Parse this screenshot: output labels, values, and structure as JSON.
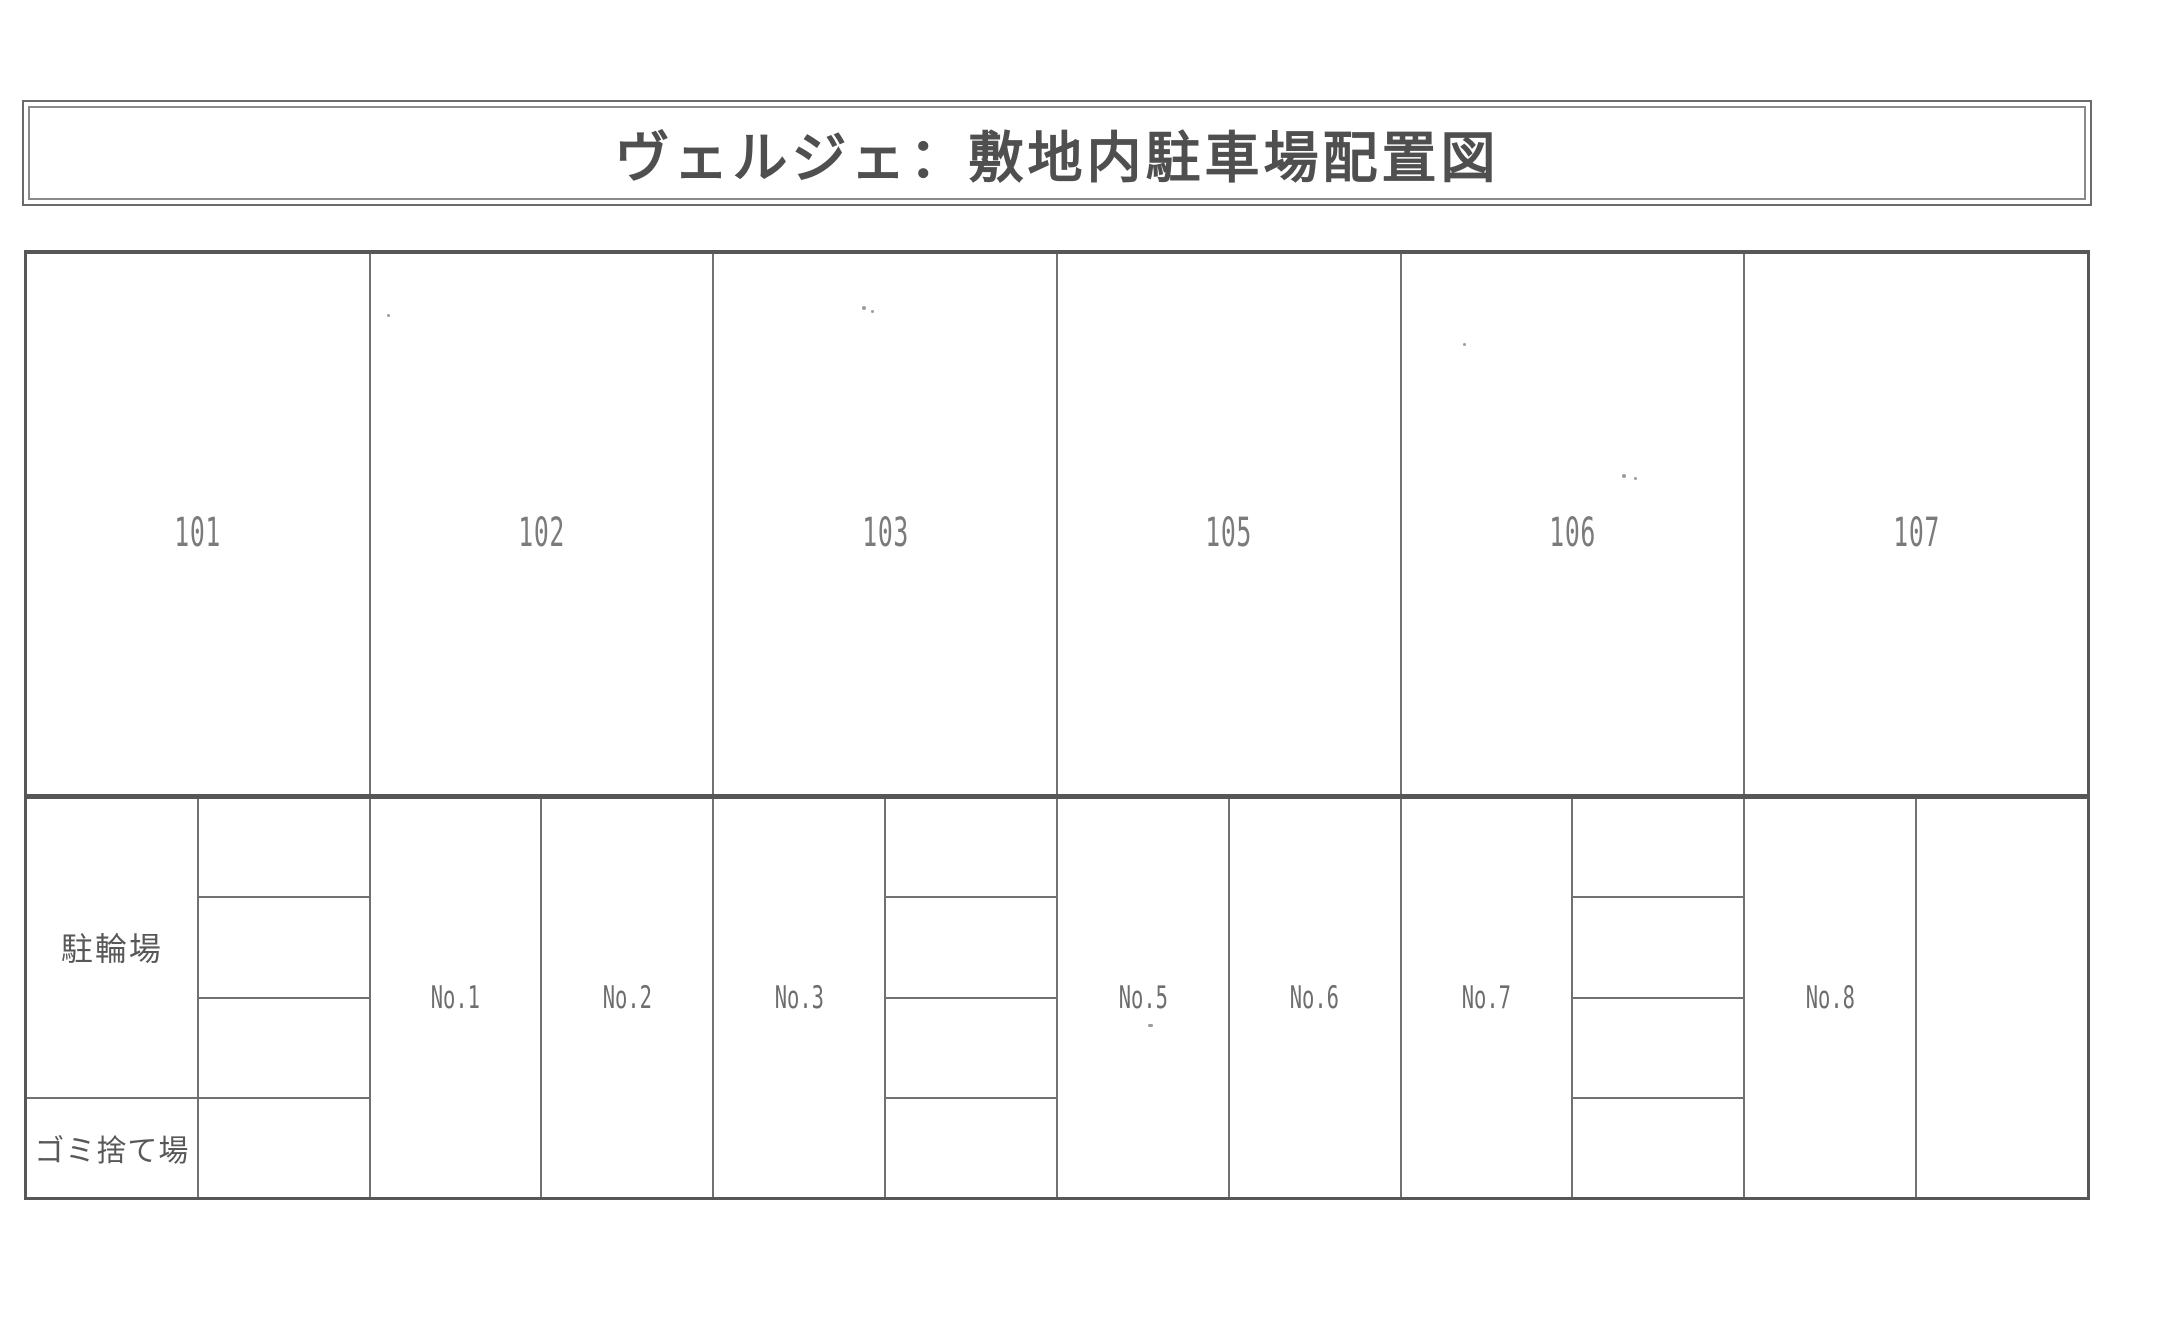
{
  "title": "ヴェルジェ：敷地内駐車場配置図",
  "units": [
    "101",
    "102",
    "103",
    "105",
    "106",
    "107"
  ],
  "facilities": {
    "bicycle_parking": "駐輪場",
    "garbage_area": "ゴミ捨て場"
  },
  "spots": [
    "No.1",
    "No.2",
    "No.3",
    "No.5",
    "No.6",
    "No.7",
    "No.8"
  ],
  "colors": {
    "grid_line": "#717171",
    "heavy_line": "#565656",
    "title_text": "#4f4f4f",
    "unit_text": "#7b7b7b",
    "jp_text": "#585858",
    "background": "#ffffff"
  }
}
